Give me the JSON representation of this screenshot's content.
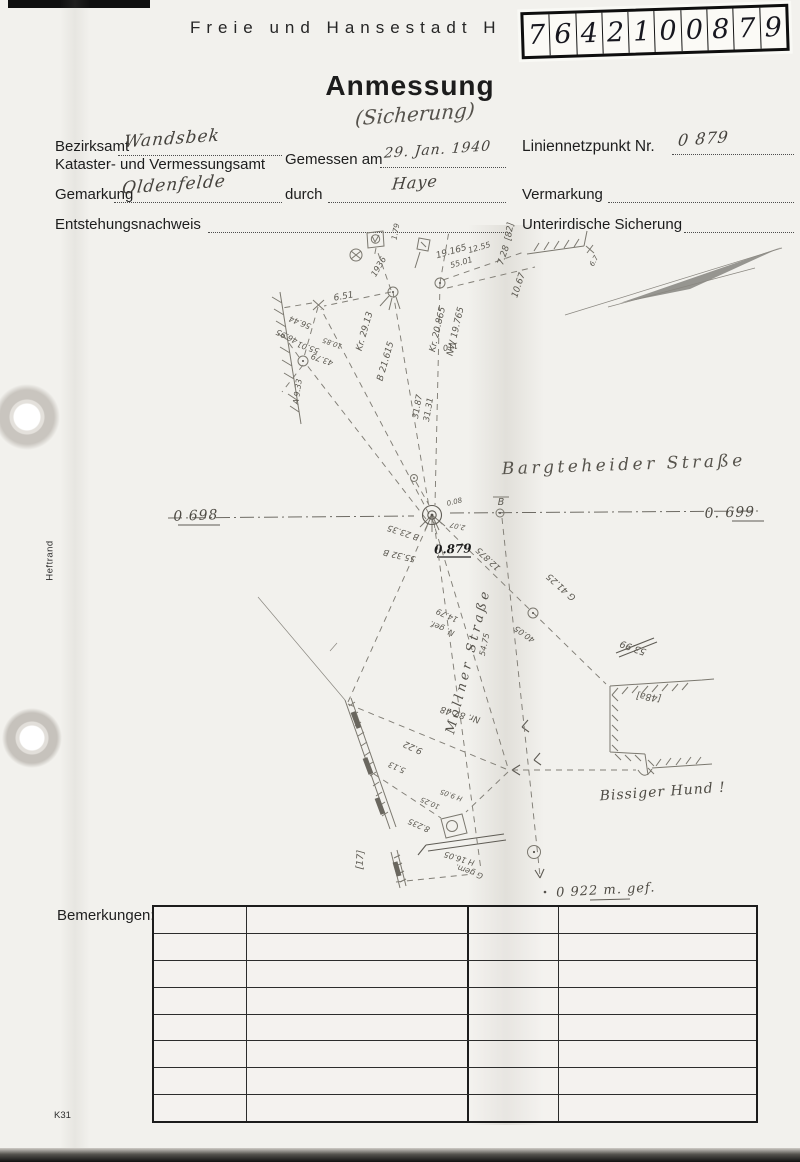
{
  "header": {
    "agency": "Freie und Hansestadt H",
    "sticker_digits": [
      "7",
      "6",
      "4",
      "2",
      "1",
      "0",
      "0",
      "8",
      "7",
      "9"
    ],
    "title": "Anmessung",
    "subtitle": "(Sicherung)"
  },
  "form": {
    "bezirksamt_label": "Bezirksamt",
    "bezirksamt_value": "Wandsbek",
    "kataster_label": "Kataster- und Vermessungsamt",
    "gemessen_label": "Gemessen am",
    "gemessen_value": "29. Jan. 1940",
    "liniennetzpunkt_label": "Liniennetzpunkt Nr.",
    "liniennetzpunkt_value": "0 879",
    "gemarkung_label": "Gemarkung",
    "gemarkung_value": "Oldenfelde",
    "durch_label": "durch",
    "durch_value": "Haye",
    "vermarkung_label": "Vermarkung",
    "entstehung_label": "Entstehungsnachweis",
    "unterirdisch_label": "Unterirdische Sicherung"
  },
  "sketch": {
    "labels": [
      {
        "text": "[82]",
        "x": 512,
        "y": 232,
        "rot": -80,
        "size": 9
      },
      {
        "text": "7.28",
        "x": 506,
        "y": 256,
        "rot": -72,
        "size": 9
      },
      {
        "text": "10.67",
        "x": 521,
        "y": 286,
        "rot": -72,
        "size": 9
      },
      {
        "text": "19.165",
        "x": 452,
        "y": 254,
        "rot": -16,
        "size": 9
      },
      {
        "text": "55.01",
        "x": 462,
        "y": 265,
        "rot": -16,
        "size": 8
      },
      {
        "text": "12.55",
        "x": 480,
        "y": 250,
        "rot": -16,
        "size": 8
      },
      {
        "text": "1936",
        "x": 381,
        "y": 268,
        "rot": -60,
        "size": 8.5
      },
      {
        "text": "1.79",
        "x": 398,
        "y": 232,
        "rot": -80,
        "size": 7.5
      },
      {
        "text": "6.7",
        "x": 596,
        "y": 262,
        "rot": -60,
        "size": 7
      },
      {
        "text": "6.51",
        "x": 344,
        "y": 299,
        "rot": -10,
        "size": 9
      },
      {
        "text": "Kr. 29.13",
        "x": 367,
        "y": 332,
        "rot": -74,
        "size": 9
      },
      {
        "text": "B 21.615",
        "x": 388,
        "y": 362,
        "rot": -74,
        "size": 9
      },
      {
        "text": "Kr. 20.865",
        "x": 440,
        "y": 330,
        "rot": -77,
        "size": 9
      },
      {
        "text": "NW 19.765",
        "x": 458,
        "y": 332,
        "rot": -77,
        "size": 9
      },
      {
        "text": "110",
        "x": 450,
        "y": 344,
        "rot": 170,
        "size": 8
      },
      {
        "text": "56.44",
        "x": 301,
        "y": 320,
        "rot": 202,
        "size": 8
      },
      {
        "text": "46.95",
        "x": 288,
        "y": 334,
        "rot": 206,
        "size": 8
      },
      {
        "text": "55.01",
        "x": 309,
        "y": 345,
        "rot": 200,
        "size": 8
      },
      {
        "text": "43.79",
        "x": 323,
        "y": 357,
        "rot": 200,
        "size": 8
      },
      {
        "text": "10.85",
        "x": 333,
        "y": 341,
        "rot": 200,
        "size": 7
      },
      {
        "text": "A 9.33",
        "x": 300,
        "y": 392,
        "rot": -82,
        "size": 8
      },
      {
        "text": "31.87",
        "x": 420,
        "y": 407,
        "rot": -80,
        "size": 8.5
      },
      {
        "text": "31.31",
        "x": 431,
        "y": 410,
        "rot": -80,
        "size": 8.5
      },
      {
        "text": "Bargteheider Straße",
        "x": 624,
        "y": 470,
        "rot": -2,
        "size": 17,
        "cls": "street"
      },
      {
        "text": "0 698",
        "x": 196,
        "y": 520,
        "rot": -2,
        "size": 14,
        "cls": "hand"
      },
      {
        "text": "0. 699",
        "x": 730,
        "y": 517,
        "rot": -2,
        "size": 14,
        "cls": "hand"
      },
      {
        "text": "0.879",
        "x": 453,
        "y": 553,
        "rot": -2,
        "size": 12,
        "cls": "ink"
      },
      {
        "text": "B",
        "x": 501,
        "y": 505,
        "rot": 0,
        "size": 9.5
      },
      {
        "text": "0.08",
        "x": 455,
        "y": 504,
        "rot": -14,
        "size": 7
      },
      {
        "text": "2.07",
        "x": 458,
        "y": 524,
        "rot": 192,
        "size": 7
      },
      {
        "text": "B 23.35",
        "x": 404,
        "y": 530,
        "rot": 198,
        "size": 8.5
      },
      {
        "text": "55.32 B",
        "x": 400,
        "y": 553,
        "rot": 193,
        "size": 8.5
      },
      {
        "text": "12.875",
        "x": 490,
        "y": 557,
        "rot": 223,
        "size": 8.5
      },
      {
        "text": "G 41.25",
        "x": 563,
        "y": 585,
        "rot": 222,
        "size": 9
      },
      {
        "text": "40.05",
        "x": 526,
        "y": 632,
        "rot": 215,
        "size": 8
      },
      {
        "text": "53.99",
        "x": 634,
        "y": 645,
        "rot": 200,
        "size": 9.5
      },
      {
        "text": "[48a]",
        "x": 649,
        "y": 694,
        "rot": 187,
        "size": 9.5
      },
      {
        "text": "14.79",
        "x": 448,
        "y": 613,
        "rot": 204,
        "size": 8
      },
      {
        "text": "N. gef.",
        "x": 443,
        "y": 626,
        "rot": 204,
        "size": 8
      },
      {
        "text": "Möllner Straße",
        "x": 472,
        "y": 662,
        "rot": -76,
        "size": 13,
        "cls": "street"
      },
      {
        "text": "54.75",
        "x": 487,
        "y": 645,
        "rot": -78,
        "size": 8
      },
      {
        "text": "Nr. 87.48",
        "x": 461,
        "y": 712,
        "rot": 196,
        "size": 9
      },
      {
        "text": "9.22",
        "x": 414,
        "y": 745,
        "rot": 204,
        "size": 9
      },
      {
        "text": "5.13",
        "x": 398,
        "y": 765,
        "rot": 204,
        "size": 8
      },
      {
        "text": "[17]",
        "x": 363,
        "y": 860,
        "rot": -86,
        "size": 9.5
      },
      {
        "text": "H 9.05",
        "x": 452,
        "y": 793,
        "rot": 200,
        "size": 7
      },
      {
        "text": "10.25",
        "x": 431,
        "y": 801,
        "rot": 204,
        "size": 7
      },
      {
        "text": "8.235",
        "x": 420,
        "y": 823,
        "rot": 204,
        "size": 8
      },
      {
        "text": "H 16.05",
        "x": 460,
        "y": 856,
        "rot": 197,
        "size": 8
      },
      {
        "text": "G gem.",
        "x": 470,
        "y": 869,
        "rot": 200,
        "size": 8
      },
      {
        "text": "Bissiger Hund !",
        "x": 663,
        "y": 796,
        "rot": -4,
        "size": 14,
        "cls": "hand"
      },
      {
        "text": "0 922 m. gef.",
        "x": 606,
        "y": 894,
        "rot": -3,
        "size": 13,
        "cls": "hand"
      }
    ]
  },
  "remarks": {
    "label": "Bemerkungen:"
  },
  "footer": {
    "form_code": "K31"
  },
  "margin": {
    "heftrand": "Heftrand"
  }
}
